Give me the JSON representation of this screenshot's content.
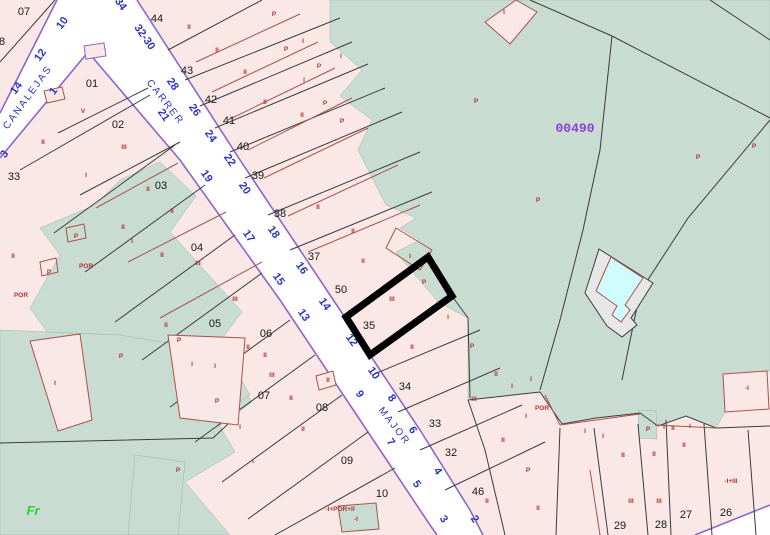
{
  "map": {
    "kind": "cadastral-parcel-map",
    "selected_parcel": "35",
    "sector_label": {
      "text": "00490",
      "x": 575,
      "y": 132
    },
    "corner_label": {
      "text": "Fr",
      "x": 33,
      "y": 515
    },
    "pool_label": {
      "text": "PI",
      "x": 617,
      "y": 291
    },
    "street_names": [
      {
        "text": "CANALEJAS",
        "x": 30,
        "y": 99,
        "rot": -54
      },
      {
        "text": "CARRER",
        "x": 163,
        "y": 104,
        "rot": 52
      },
      {
        "text": "MAJOR",
        "x": 392,
        "y": 428,
        "rot": 52
      }
    ],
    "house_numbers": [
      {
        "text": "34",
        "x": 118,
        "y": 6,
        "rot": 55
      },
      {
        "text": "32-30",
        "x": 142,
        "y": 39,
        "rot": 55
      },
      {
        "text": "28",
        "x": 170,
        "y": 86,
        "rot": 55
      },
      {
        "text": "26",
        "x": 192,
        "y": 112,
        "rot": 55
      },
      {
        "text": "24",
        "x": 208,
        "y": 138,
        "rot": 55
      },
      {
        "text": "22",
        "x": 227,
        "y": 162,
        "rot": 55
      },
      {
        "text": "20",
        "x": 242,
        "y": 190,
        "rot": 55
      },
      {
        "text": "18",
        "x": 271,
        "y": 234,
        "rot": 55
      },
      {
        "text": "16",
        "x": 299,
        "y": 270,
        "rot": 55
      },
      {
        "text": "14",
        "x": 322,
        "y": 306,
        "rot": 55
      },
      {
        "text": "12",
        "x": 349,
        "y": 342,
        "rot": 55
      },
      {
        "text": "10",
        "x": 371,
        "y": 375,
        "rot": 55
      },
      {
        "text": "8",
        "x": 389,
        "y": 400,
        "rot": 55
      },
      {
        "text": "6",
        "x": 410,
        "y": 432,
        "rot": 55
      },
      {
        "text": "4",
        "x": 435,
        "y": 473,
        "rot": 55
      },
      {
        "text": "2",
        "x": 472,
        "y": 521,
        "rot": 55
      },
      {
        "text": "21",
        "x": 161,
        "y": 117,
        "rot": 55
      },
      {
        "text": "19",
        "x": 204,
        "y": 178,
        "rot": 55
      },
      {
        "text": "17",
        "x": 246,
        "y": 238,
        "rot": 55
      },
      {
        "text": "15",
        "x": 276,
        "y": 281,
        "rot": 55
      },
      {
        "text": "13",
        "x": 301,
        "y": 317,
        "rot": 55
      },
      {
        "text": "9",
        "x": 357,
        "y": 396,
        "rot": 55
      },
      {
        "text": "7",
        "x": 388,
        "y": 444,
        "rot": 55
      },
      {
        "text": "5",
        "x": 414,
        "y": 486,
        "rot": 55
      },
      {
        "text": "3",
        "x": 441,
        "y": 521,
        "rot": 55
      },
      {
        "text": "14",
        "x": 19,
        "y": 90,
        "rot": -54
      },
      {
        "text": "12",
        "x": 43,
        "y": 57,
        "rot": -54
      },
      {
        "text": "10",
        "x": 65,
        "y": 25,
        "rot": -54
      },
      {
        "text": "3",
        "x": 7,
        "y": 156,
        "rot": -54
      },
      {
        "text": "1",
        "x": 56,
        "y": 93,
        "rot": -54
      }
    ],
    "parcel_numbers": [
      {
        "text": "07",
        "x": 24,
        "y": 15
      },
      {
        "text": "8",
        "x": 2,
        "y": 45
      },
      {
        "text": "01",
        "x": 92,
        "y": 87
      },
      {
        "text": "02",
        "x": 118,
        "y": 128
      },
      {
        "text": "33",
        "x": 14,
        "y": 180
      },
      {
        "text": "03",
        "x": 161,
        "y": 189
      },
      {
        "text": "04",
        "x": 197,
        "y": 251
      },
      {
        "text": "05",
        "x": 215,
        "y": 327
      },
      {
        "text": "06",
        "x": 266,
        "y": 337
      },
      {
        "text": "07",
        "x": 264,
        "y": 399
      },
      {
        "text": "08",
        "x": 322,
        "y": 411
      },
      {
        "text": "09",
        "x": 347,
        "y": 464
      },
      {
        "text": "10",
        "x": 382,
        "y": 497
      },
      {
        "text": "44",
        "x": 157,
        "y": 22
      },
      {
        "text": "43",
        "x": 187,
        "y": 74
      },
      {
        "text": "42",
        "x": 211,
        "y": 103
      },
      {
        "text": "41",
        "x": 229,
        "y": 124
      },
      {
        "text": "40",
        "x": 243,
        "y": 150
      },
      {
        "text": "39",
        "x": 258,
        "y": 179
      },
      {
        "text": "38",
        "x": 280,
        "y": 217
      },
      {
        "text": "37",
        "x": 314,
        "y": 260
      },
      {
        "text": "50",
        "x": 341,
        "y": 293
      },
      {
        "text": "35",
        "x": 369,
        "y": 329
      },
      {
        "text": "34",
        "x": 405,
        "y": 390
      },
      {
        "text": "33",
        "x": 435,
        "y": 427
      },
      {
        "text": "32",
        "x": 451,
        "y": 456
      },
      {
        "text": "46",
        "x": 478,
        "y": 495
      },
      {
        "text": "29",
        "x": 620,
        "y": 529
      },
      {
        "text": "28",
        "x": 661,
        "y": 528
      },
      {
        "text": "27",
        "x": 686,
        "y": 518
      },
      {
        "text": "26",
        "x": 726,
        "y": 516
      }
    ],
    "building_labels": [
      {
        "text": "II",
        "x": 189,
        "y": 29
      },
      {
        "text": "II",
        "x": 217,
        "y": 52
      },
      {
        "text": "II",
        "x": 245,
        "y": 74
      },
      {
        "text": "II",
        "x": 265,
        "y": 104
      },
      {
        "text": "P",
        "x": 274,
        "y": 16
      },
      {
        "text": "P",
        "x": 286,
        "y": 51
      },
      {
        "text": "I",
        "x": 303,
        "y": 43
      },
      {
        "text": "P",
        "x": 319,
        "y": 68
      },
      {
        "text": "I",
        "x": 341,
        "y": 58
      },
      {
        "text": "I",
        "x": 304,
        "y": 82
      },
      {
        "text": "P",
        "x": 325,
        "y": 105
      },
      {
        "text": "II",
        "x": 302,
        "y": 117
      },
      {
        "text": "P",
        "x": 342,
        "y": 123
      },
      {
        "text": "II",
        "x": 318,
        "y": 209
      },
      {
        "text": "II",
        "x": 353,
        "y": 233
      },
      {
        "text": "II",
        "x": 363,
        "y": 263
      },
      {
        "text": "I",
        "x": 410,
        "y": 258
      },
      {
        "text": "P",
        "x": 424,
        "y": 284
      },
      {
        "text": "III",
        "x": 392,
        "y": 301
      },
      {
        "text": "I",
        "x": 448,
        "y": 319
      },
      {
        "text": "II",
        "x": 412,
        "y": 349
      },
      {
        "text": "P",
        "x": 472,
        "y": 348
      },
      {
        "text": "II",
        "x": 496,
        "y": 376
      },
      {
        "text": "III",
        "x": 474,
        "y": 401
      },
      {
        "text": "I",
        "x": 512,
        "y": 388
      },
      {
        "text": "I",
        "x": 531,
        "y": 381
      },
      {
        "text": "POR",
        "x": 542,
        "y": 410
      },
      {
        "text": "I",
        "x": 526,
        "y": 418
      },
      {
        "text": "II",
        "x": 503,
        "y": 442
      },
      {
        "text": "P",
        "x": 528,
        "y": 472
      },
      {
        "text": "II",
        "x": 487,
        "y": 503
      },
      {
        "text": "II",
        "x": 538,
        "y": 510
      },
      {
        "text": "I",
        "x": 585,
        "y": 433
      },
      {
        "text": "I",
        "x": 603,
        "y": 438
      },
      {
        "text": "II",
        "x": 623,
        "y": 457
      },
      {
        "text": "III",
        "x": 631,
        "y": 503
      },
      {
        "text": "P",
        "x": 648,
        "y": 431
      },
      {
        "text": "I",
        "x": 664,
        "y": 429
      },
      {
        "text": "II",
        "x": 673,
        "y": 430
      },
      {
        "text": "I",
        "x": 690,
        "y": 428
      },
      {
        "text": "II",
        "x": 684,
        "y": 447
      },
      {
        "text": "II",
        "x": 654,
        "y": 456
      },
      {
        "text": "III",
        "x": 659,
        "y": 503
      },
      {
        "text": "-I+III",
        "x": 731,
        "y": 483
      },
      {
        "text": "-I",
        "x": 747,
        "y": 390
      },
      {
        "text": "P",
        "x": 754,
        "y": 148
      },
      {
        "text": "P",
        "x": 698,
        "y": 159
      },
      {
        "text": "P",
        "x": 538,
        "y": 202
      },
      {
        "text": "P",
        "x": 476,
        "y": 103
      },
      {
        "text": "I",
        "x": 504,
        "y": 14
      },
      {
        "text": "V",
        "x": 83,
        "y": 113
      },
      {
        "text": "III",
        "x": 124,
        "y": 149
      },
      {
        "text": "II",
        "x": 43,
        "y": 144
      },
      {
        "text": "I",
        "x": 86,
        "y": 177
      },
      {
        "text": "II",
        "x": 148,
        "y": 191
      },
      {
        "text": "II",
        "x": 172,
        "y": 213
      },
      {
        "text": "II",
        "x": 123,
        "y": 229
      },
      {
        "text": "I",
        "x": 132,
        "y": 243
      },
      {
        "text": "II",
        "x": 162,
        "y": 257
      },
      {
        "text": "II",
        "x": 13,
        "y": 258
      },
      {
        "text": "P",
        "x": 76,
        "y": 238
      },
      {
        "text": "P",
        "x": 49,
        "y": 274
      },
      {
        "text": "POR",
        "x": 86,
        "y": 268
      },
      {
        "text": "POR",
        "x": 21,
        "y": 297
      },
      {
        "text": "III",
        "x": 198,
        "y": 265
      },
      {
        "text": "III",
        "x": 235,
        "y": 301
      },
      {
        "text": "II",
        "x": 166,
        "y": 327
      },
      {
        "text": "P",
        "x": 179,
        "y": 342
      },
      {
        "text": "P",
        "x": 121,
        "y": 358
      },
      {
        "text": "I",
        "x": 192,
        "y": 366
      },
      {
        "text": "I",
        "x": 215,
        "y": 368
      },
      {
        "text": "II",
        "x": 248,
        "y": 349
      },
      {
        "text": "II",
        "x": 265,
        "y": 357
      },
      {
        "text": "III",
        "x": 272,
        "y": 377
      },
      {
        "text": "P",
        "x": 217,
        "y": 403
      },
      {
        "text": "I",
        "x": 55,
        "y": 385
      },
      {
        "text": "P",
        "x": 178,
        "y": 472
      },
      {
        "text": "II",
        "x": 328,
        "y": 382
      },
      {
        "text": "II",
        "x": 291,
        "y": 400
      },
      {
        "text": "II",
        "x": 303,
        "y": 431
      },
      {
        "text": "I",
        "x": 240,
        "y": 429
      },
      {
        "text": "I",
        "x": 253,
        "y": 463
      },
      {
        "text": "-I+POR+II",
        "x": 340,
        "y": 511
      },
      {
        "text": "-I",
        "x": 356,
        "y": 521
      }
    ],
    "colors": {
      "parcel_fill": "#f9e8e5",
      "green_fill": "#c8dcd2",
      "street_fill": "#ffffff",
      "street_edge": "#8b66cc",
      "boundary": "#3c3c3c",
      "building_outline": "#a8544c",
      "label_red": "#b23430",
      "label_blue": "#2b35c0",
      "label_black": "#1a1a1a",
      "sector_purple": "#8e3fd1",
      "fr_green": "#2ecc40",
      "highlight": "#000000",
      "pool_fill": "#cffcff",
      "pool_band": "#e7e7e7"
    }
  }
}
